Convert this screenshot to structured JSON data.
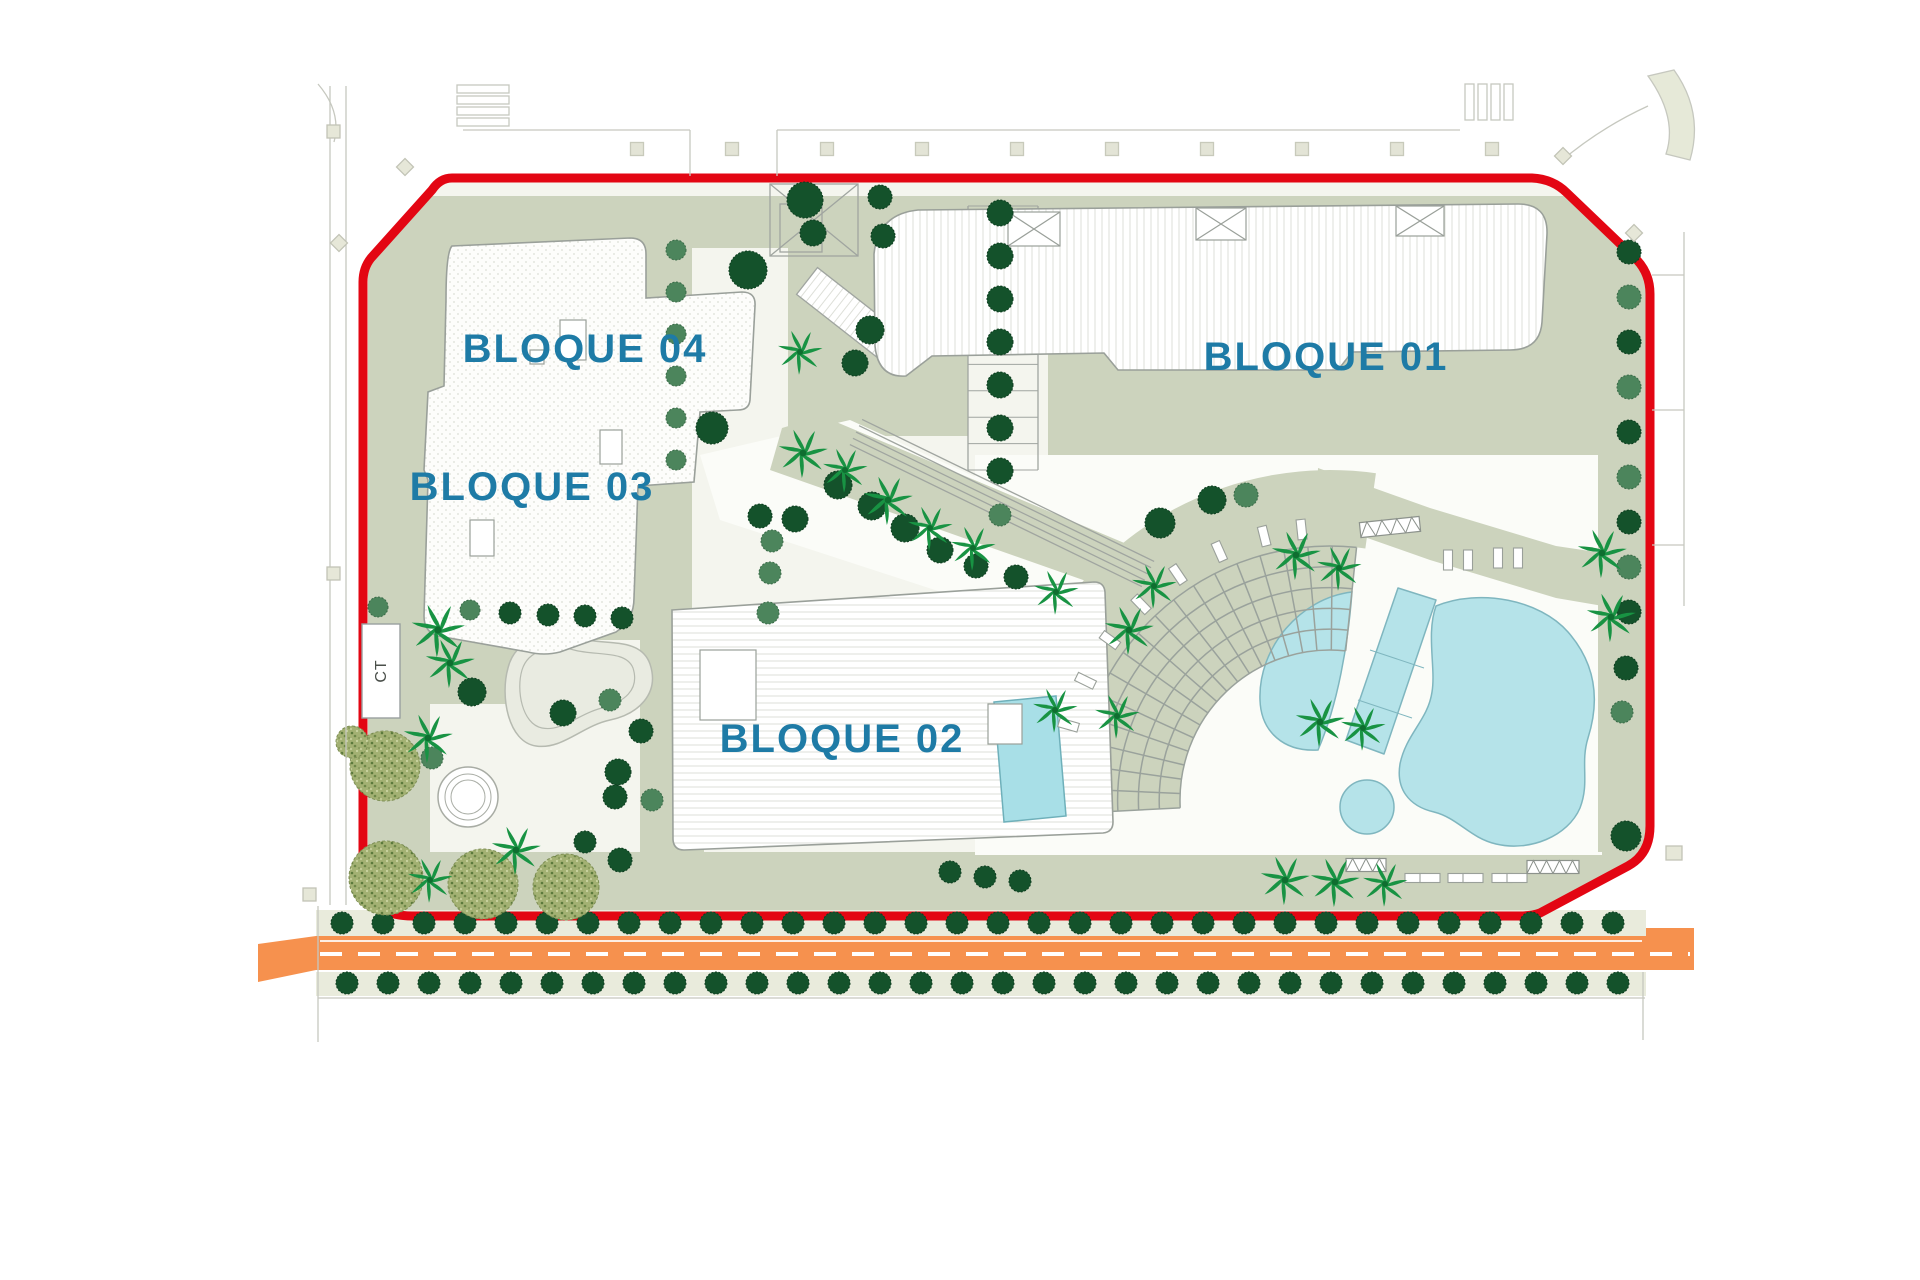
{
  "plan": {
    "blocks": [
      {
        "id": "bloque-01",
        "label": "BLOQUE 01"
      },
      {
        "id": "bloque-02",
        "label": "BLOQUE 02"
      },
      {
        "id": "bloque-03",
        "label": "BLOQUE 03"
      },
      {
        "id": "bloque-04",
        "label": "BLOQUE 04"
      }
    ],
    "ct_label": "CT"
  },
  "colors": {
    "boundary_red": "#e30613",
    "label_blue": "#1e7ba6",
    "road_orange": "#f6914e",
    "sage": "#ccd3bd",
    "pale": "#f4f5ee",
    "plaza_white": "#fbfcf8",
    "sidewalk": "#e9ebdc",
    "pool_blue": "#b5e3e9",
    "pool_stroke": "#7fb6bf",
    "tree_dark": "#14522b",
    "tree_medium": "#4c855c",
    "palm_green": "#189343",
    "mottled_olive": "#a3b173",
    "line_gray": "#a7aba3"
  },
  "trees": {
    "road_rows": [
      {
        "y": 923,
        "x_start": 342,
        "spacing": 41,
        "count": 32,
        "r": 11
      },
      {
        "y": 983,
        "x_start": 347,
        "spacing": 41,
        "count": 32,
        "r": 11
      }
    ],
    "columns": [
      {
        "x": 1000,
        "y_start": 213,
        "spacing": 43,
        "count": 7,
        "r": 13,
        "tone": "dark"
      },
      {
        "x": 676,
        "y_start": 250,
        "spacing": 42,
        "count": 6,
        "r": 10,
        "tone": "medium"
      },
      {
        "x": 1629,
        "y_start": 252,
        "spacing": 45,
        "count": 9,
        "r": 12,
        "tone": "alt"
      }
    ],
    "dark": [
      [
        748,
        270,
        19
      ],
      [
        712,
        428,
        16
      ],
      [
        795,
        519,
        13
      ],
      [
        805,
        200,
        18
      ],
      [
        813,
        233,
        13
      ],
      [
        880,
        197,
        12
      ],
      [
        883,
        236,
        12
      ],
      [
        870,
        330,
        14
      ],
      [
        855,
        363,
        13
      ],
      [
        838,
        485,
        14
      ],
      [
        872,
        506,
        14
      ],
      [
        905,
        528,
        14
      ],
      [
        940,
        550,
        13
      ],
      [
        976,
        566,
        12
      ],
      [
        1016,
        577,
        12
      ],
      [
        760,
        516,
        12
      ],
      [
        1160,
        523,
        15
      ],
      [
        1212,
        500,
        14
      ],
      [
        472,
        692,
        14
      ],
      [
        563,
        713,
        13
      ],
      [
        641,
        731,
        12
      ],
      [
        618,
        772,
        13
      ],
      [
        615,
        797,
        12
      ],
      [
        620,
        860,
        12
      ],
      [
        585,
        842,
        11
      ],
      [
        510,
        613,
        11
      ],
      [
        548,
        615,
        11
      ],
      [
        585,
        616,
        11
      ],
      [
        622,
        618,
        11
      ],
      [
        950,
        872,
        11
      ],
      [
        985,
        877,
        11
      ],
      [
        1020,
        881,
        11
      ],
      [
        1626,
        668,
        12
      ],
      [
        1626,
        836,
        15
      ]
    ],
    "medium": [
      [
        1246,
        495,
        12
      ],
      [
        610,
        700,
        11
      ],
      [
        432,
        758,
        11
      ],
      [
        652,
        800,
        11
      ],
      [
        378,
        607,
        10
      ],
      [
        470,
        610,
        10
      ],
      [
        772,
        541,
        11
      ],
      [
        770,
        573,
        11
      ],
      [
        768,
        613,
        11
      ],
      [
        1622,
        712,
        11
      ],
      [
        1000,
        515,
        11
      ]
    ],
    "palms": [
      [
        800,
        352,
        1.0
      ],
      [
        803,
        453,
        1.1
      ],
      [
        845,
        470,
        1.0
      ],
      [
        888,
        500,
        1.1
      ],
      [
        930,
        528,
        1.0
      ],
      [
        973,
        548,
        1.0
      ],
      [
        1056,
        592,
        1.0
      ],
      [
        1296,
        555,
        1.1
      ],
      [
        1339,
        568,
        1.0
      ],
      [
        1602,
        553,
        1.1
      ],
      [
        1611,
        617,
        1.1
      ],
      [
        1154,
        586,
        1.0
      ],
      [
        1129,
        630,
        1.1
      ],
      [
        1055,
        710,
        1.0
      ],
      [
        1117,
        716,
        1.0
      ],
      [
        1320,
        722,
        1.1
      ],
      [
        1363,
        728,
        1.0
      ],
      [
        1285,
        880,
        1.1
      ],
      [
        1335,
        882,
        1.1
      ],
      [
        1385,
        884,
        1.0
      ],
      [
        438,
        630,
        1.2
      ],
      [
        450,
        663,
        1.1
      ],
      [
        428,
        738,
        1.1
      ],
      [
        516,
        850,
        1.1
      ],
      [
        430,
        880,
        1.0
      ]
    ],
    "mottled": [
      [
        385,
        766,
        35
      ],
      [
        386,
        878,
        37
      ],
      [
        483,
        884,
        35
      ],
      [
        566,
        887,
        33
      ],
      [
        352,
        742,
        16
      ]
    ]
  },
  "amphitheater": {
    "cx": 1330,
    "cy": 800,
    "r_inner": 150,
    "r_outer": 254,
    "angle_start": 177,
    "angle_end": 276,
    "arc_count": 6,
    "spoke_count": 19
  },
  "terrace": {
    "r_inner": 254,
    "r_outer": 330,
    "angle_start": 205,
    "angle_end": 278
  },
  "loungers": {
    "arc": {
      "r": 272,
      "angles": [
        196,
        206,
        216,
        226,
        236,
        246,
        256,
        264
      ]
    },
    "rows": [
      [
        1448,
        560,
        0
      ],
      [
        1468,
        560,
        0
      ],
      [
        1498,
        558,
        0
      ],
      [
        1518,
        558,
        0
      ],
      [
        1415,
        878,
        90
      ],
      [
        1430,
        878,
        90
      ],
      [
        1458,
        878,
        90
      ],
      [
        1473,
        878,
        90
      ],
      [
        1502,
        878,
        90
      ],
      [
        1517,
        878,
        90
      ]
    ]
  },
  "street_squares": {
    "y": 149,
    "xs": [
      637,
      732,
      827,
      922,
      1017,
      1112,
      1207,
      1302,
      1397,
      1492
    ]
  },
  "pergola_hatch": [
    [
      1390,
      527,
      60,
      15,
      -6
    ],
    [
      1553,
      867,
      52,
      13,
      0
    ],
    [
      1366,
      865,
      40,
      13,
      0
    ]
  ],
  "bridge": {
    "x1": 856,
    "y1": 432,
    "x2": 1148,
    "y2": 574,
    "lines": 5,
    "gap": 7
  },
  "walkway": {
    "x1": 968,
    "x2": 1038,
    "y1": 206,
    "y2": 470,
    "rungs": 10
  }
}
